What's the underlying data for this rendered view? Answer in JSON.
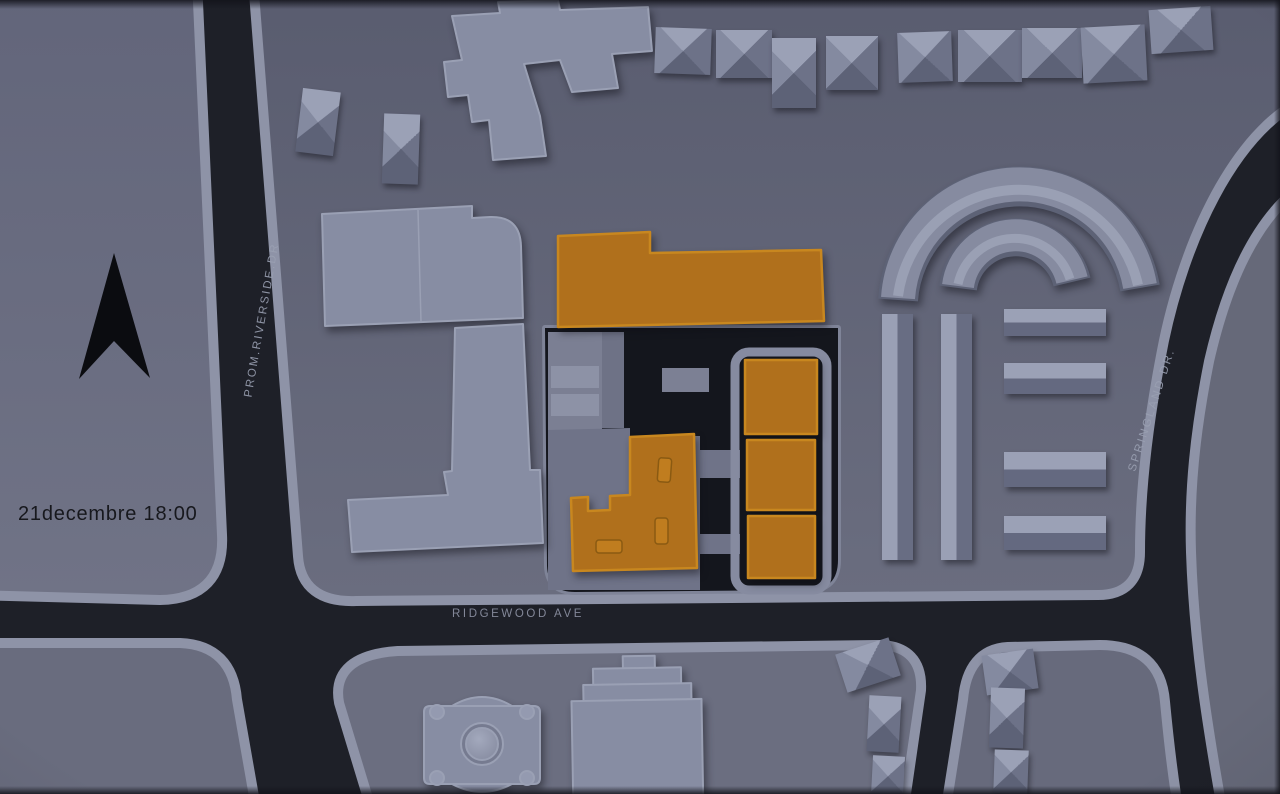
{
  "scene": {
    "title_datetime": "21decembre 18:00",
    "north_indicator": "north-arrow",
    "streets": [
      {
        "id": "riverside",
        "name": "PROM.RIVERSIDE.DR"
      },
      {
        "id": "springland",
        "name": "SPRINGLAND DR."
      },
      {
        "id": "ridgewood",
        "name": "RIDGEWOOD AVE"
      }
    ],
    "colors": {
      "road": "#1e2028",
      "city_block": "#63667a",
      "sidewalk": "#8e93a7",
      "building_context": "#878da3",
      "building_highlight": "#b0701c",
      "courtyard": "#14161d",
      "street_label_text": "#9aa0b2",
      "annotation_text": "#17181d",
      "north_arrow": "#0b0c10"
    }
  }
}
